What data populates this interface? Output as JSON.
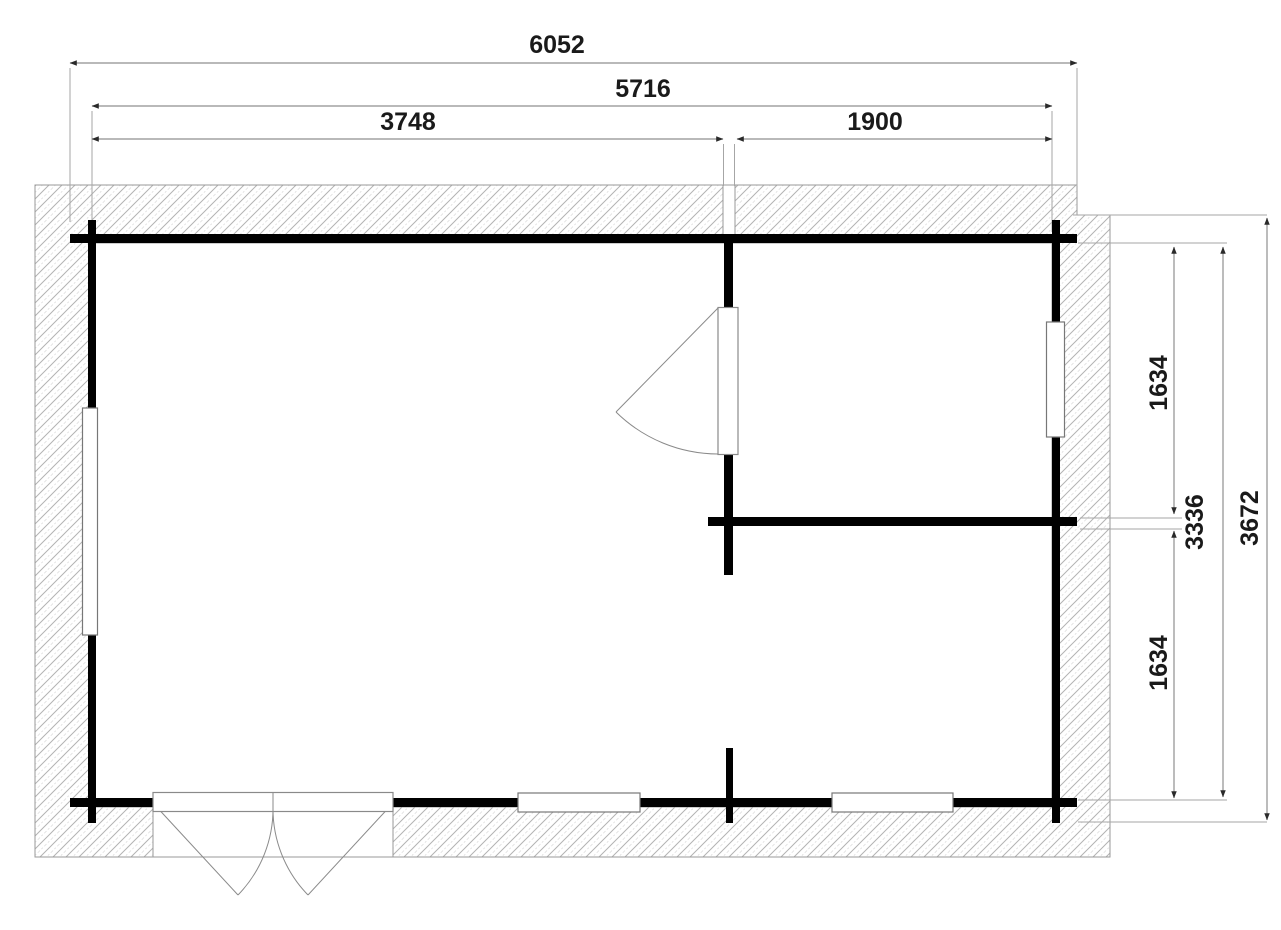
{
  "drawing": {
    "kind": "floor-plan",
    "units": "mm"
  },
  "dimensions": {
    "top": [
      {
        "name": "overall-width",
        "value": "6052"
      },
      {
        "name": "inner-width",
        "value": "5716"
      },
      {
        "name": "left-section-width",
        "value": "3748"
      },
      {
        "name": "right-section-width",
        "value": "1900"
      }
    ],
    "right": [
      {
        "name": "upper-room-depth",
        "value": "1634"
      },
      {
        "name": "inner-depth",
        "value": "3336"
      },
      {
        "name": "overall-depth",
        "value": "3672"
      },
      {
        "name": "lower-room-depth",
        "value": "1634"
      }
    ]
  },
  "colors": {
    "background": "#ffffff",
    "wall": "#000000",
    "hatch_line": "#b3b3b3",
    "dimension_line": "#8f8f8f",
    "text": "#1a1a1a"
  }
}
